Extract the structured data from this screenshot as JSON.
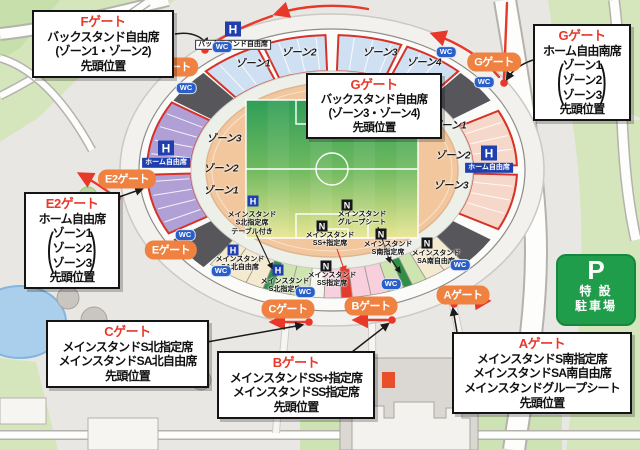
{
  "callouts": {
    "f": {
      "title": "Fゲート",
      "line1": "バックスタンド自由席",
      "line2": "(ゾーン1・ゾーン2)",
      "line3": "先頭位置"
    },
    "g_right": {
      "title": "Gゲート",
      "heading": "ホーム自由南席",
      "zone1": "ゾーン1",
      "zone2": "ゾーン2",
      "zone3": "ゾーン3",
      "footer": "先頭位置"
    },
    "g_center": {
      "title": "Gゲート",
      "line1": "バックスタンド自由席",
      "line2": "(ゾーン3・ゾーン4)",
      "line3": "先頭位置"
    },
    "e2": {
      "title": "E2ゲート",
      "heading": "ホーム自由席",
      "zone1": "ゾーン1",
      "zone2": "ゾーン2",
      "zone3": "ゾーン3",
      "footer": "先頭位置"
    },
    "c": {
      "title": "Cゲート",
      "line1": "メインスタンドS北指定席",
      "line2": "メインスタンドSA北自由席",
      "line3": "先頭位置"
    },
    "b": {
      "title": "Bゲート",
      "line1": "メインスタンドSS+指定席",
      "line2": "メインスタンドSS指定席",
      "line3": "先頭位置"
    },
    "a": {
      "title": "Aゲート",
      "line1": "メインスタンドS南指定席",
      "line2": "メインスタンドSA南自由席",
      "line3": "メインスタンドグループシート",
      "line4": "先頭位置"
    }
  },
  "gates": {
    "f": "Fゲート",
    "g": "Gゲート",
    "e2": "E2ゲート",
    "e": "Eゲート",
    "c": "Cゲート",
    "b": "Bゲート",
    "a": "Aゲート"
  },
  "wc": "WC",
  "parking": {
    "symbol": "P",
    "line1": "特 設",
    "line2": "駐車場"
  },
  "stands": {
    "back": {
      "letter": "H",
      "label": "バックスタンド自由席"
    },
    "home_left": {
      "letter": "H",
      "label": "ホーム自由席"
    },
    "home_right": {
      "letter": "H",
      "label": "ホーム自由席"
    }
  },
  "main_stand_labels": [
    {
      "letter": "H",
      "l1": "メインスタンド",
      "l2": "S北指定席",
      "l3": "テーブル付き"
    },
    {
      "letter": "N",
      "l1": "メインスタンド",
      "l2": "グループシート"
    },
    {
      "letter": "N",
      "l1": "メインスタンド",
      "l2": "SS+指定席"
    },
    {
      "letter": "N",
      "l1": "メインスタンド",
      "l2": "S南指定席"
    },
    {
      "letter": "N",
      "l1": "メインスタンド",
      "l2": "SA南自由席"
    },
    {
      "letter": "H",
      "l1": "メインスタンド",
      "l2": "SA北自由席"
    },
    {
      "letter": "H",
      "l1": "メインスタンド",
      "l2": "S北指定席"
    },
    {
      "letter": "N",
      "l1": "メインスタンド",
      "l2": "SS指定席"
    }
  ],
  "zones": {
    "top": [
      "ゾーン1",
      "ゾーン2",
      "ゾーン3",
      "ゾーン4"
    ],
    "left": [
      "ゾーン3",
      "ゾーン2",
      "ゾーン1"
    ],
    "right": [
      "ゾーン1",
      "ゾーン2",
      "ゾーン3"
    ]
  },
  "glyphs": {
    "paren_open": "(",
    "paren_close": ")"
  },
  "colors": {
    "accent_red": "#e8382a",
    "gate_orange": "#ef8141",
    "wc_blue": "#2a5ec9",
    "badge_blue": "#1f3fae",
    "parking_green": "#1f9d4b",
    "pitch_green": "#2f9e57",
    "track_peach": "#f2c59c",
    "seat_back_blue": "#cfe0f2",
    "seat_home_purple": "#b1a0d6",
    "seat_home_pink": "#f6d8ca"
  }
}
